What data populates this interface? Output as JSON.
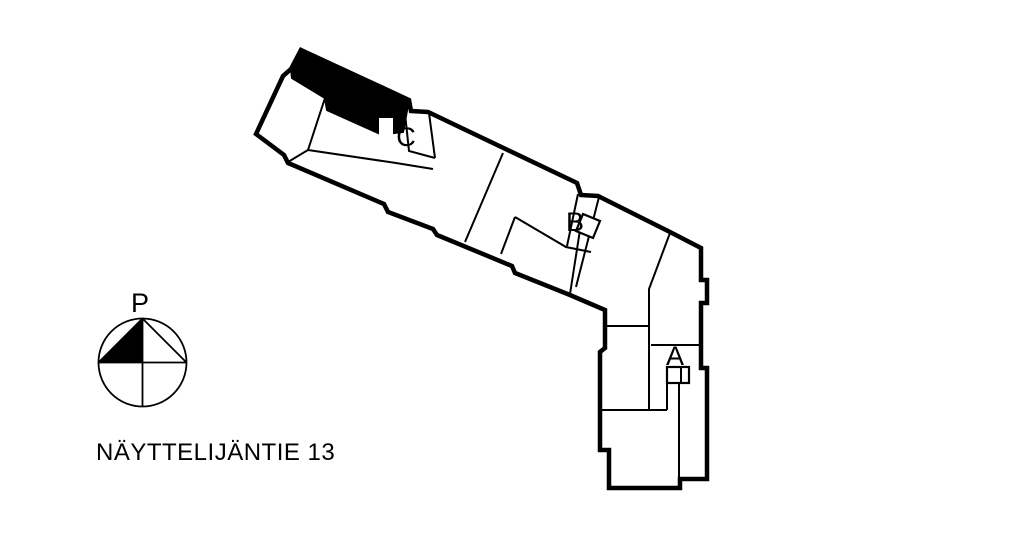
{
  "page": {
    "background_color": "#ffffff",
    "line_color": "#000000"
  },
  "floor_plan": {
    "address": "NÄYTTELIJÄNTIE 13",
    "stairwells": [
      {
        "label": "A"
      },
      {
        "label": "B"
      },
      {
        "label": "C"
      }
    ],
    "highlighted_unit_color": "#000000"
  },
  "compass": {
    "label": "P"
  }
}
